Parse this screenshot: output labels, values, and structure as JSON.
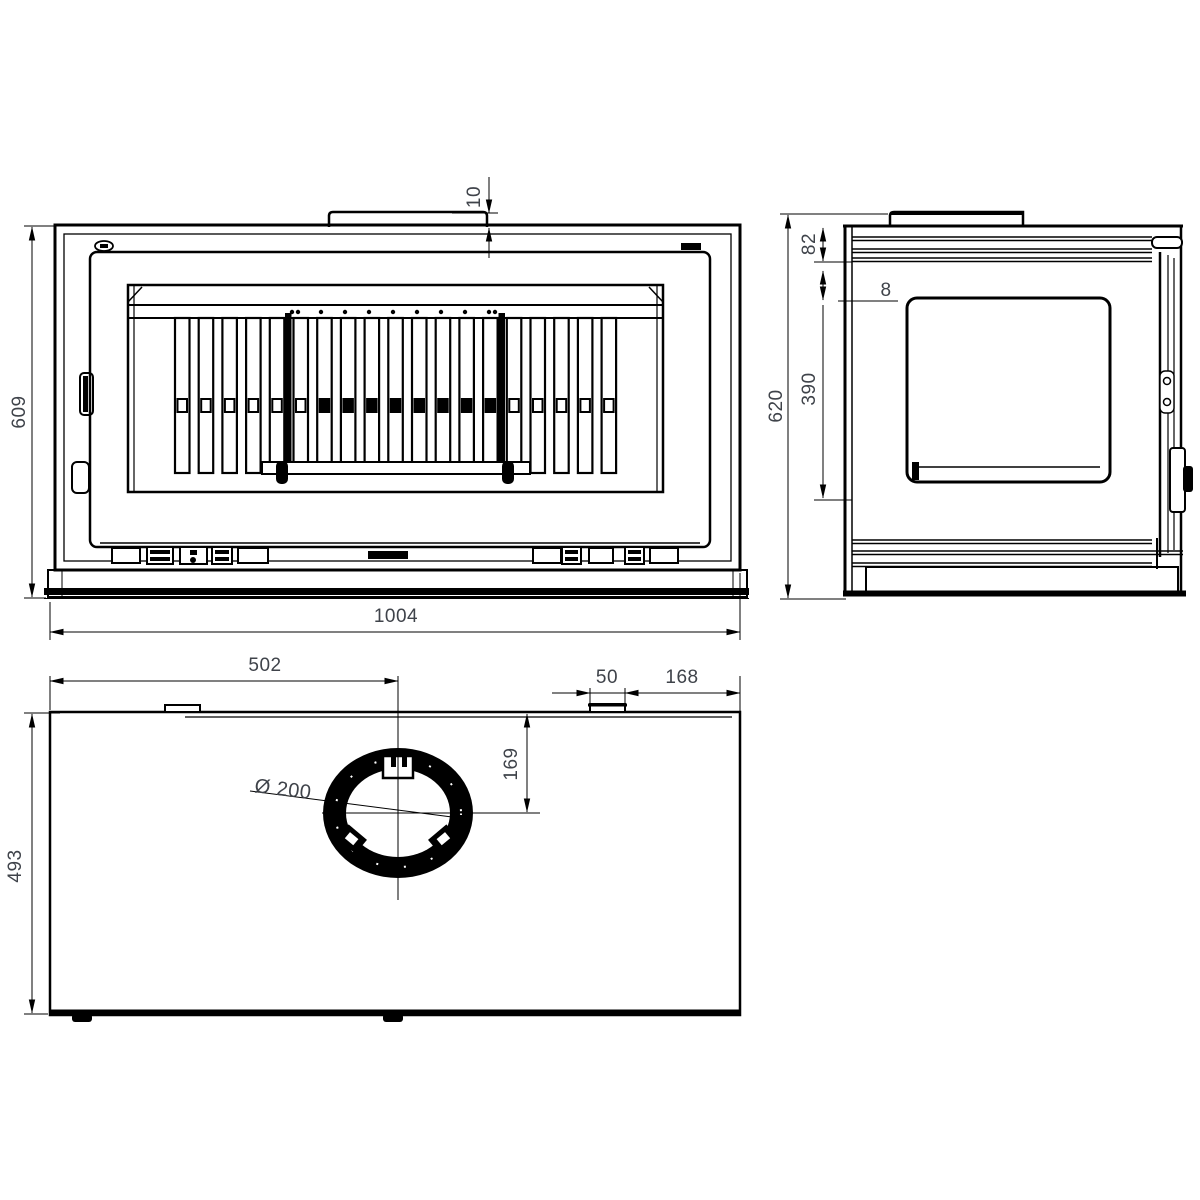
{
  "drawing_labels": {
    "front": {
      "height": "609",
      "width": "1004",
      "flue_offset": "10"
    },
    "side": {
      "overall_height": "620",
      "top_inset": "82",
      "gap": "8",
      "window_height": "390"
    },
    "top": {
      "flue_center_from_left": "502",
      "tab_width": "50",
      "tab_to_edge": "168",
      "flue_center_from_front": "169",
      "depth": "493",
      "flue_diameter": "Ø 200"
    }
  },
  "colors": {
    "line": "#000000",
    "dim_text": "#3f434a",
    "background": "#ffffff"
  }
}
